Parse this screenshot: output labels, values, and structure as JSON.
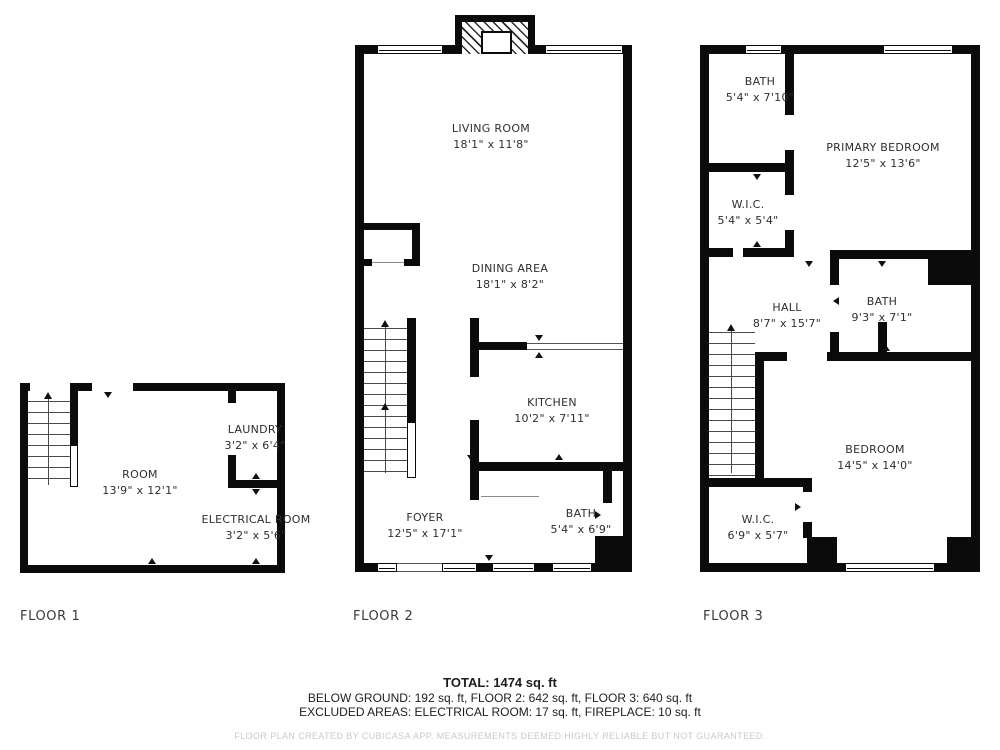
{
  "floors": [
    {
      "label": "FLOOR 1",
      "rooms": [
        {
          "name": "ROOM",
          "dims": "13'9\" x 12'1\""
        },
        {
          "name": "LAUNDRY",
          "dims": "3'2\" x 6'4\""
        },
        {
          "name": "ELECTRICAL ROOM",
          "dims": "3'2\" x 5'6\""
        }
      ]
    },
    {
      "label": "FLOOR 2",
      "rooms": [
        {
          "name": "LIVING ROOM",
          "dims": "18'1\" x 11'8\""
        },
        {
          "name": "DINING AREA",
          "dims": "18'1\" x 8'2\""
        },
        {
          "name": "KITCHEN",
          "dims": "10'2\" x 7'11\""
        },
        {
          "name": "FOYER",
          "dims": "12'5\" x 17'1\""
        },
        {
          "name": "BATH",
          "dims": "5'4\" x 6'9\""
        }
      ]
    },
    {
      "label": "FLOOR 3",
      "rooms": [
        {
          "name": "BATH",
          "dims": "5'4\" x 7'10\""
        },
        {
          "name": "PRIMARY BEDROOM",
          "dims": "12'5\" x 13'6\""
        },
        {
          "name": "W.I.C.",
          "dims": "5'4\" x 5'4\""
        },
        {
          "name": "HALL",
          "dims": "8'7\" x 15'7\""
        },
        {
          "name": "BATH",
          "dims": "9'3\" x 7'1\""
        },
        {
          "name": "BEDROOM",
          "dims": "14'5\" x 14'0\""
        },
        {
          "name": "W.I.C.",
          "dims": "6'9\" x 5'7\""
        }
      ]
    }
  ],
  "summary": {
    "total": "TOTAL: 1474 sq. ft",
    "floors_line": "BELOW GROUND: 192 sq. ft, FLOOR 2: 642 sq. ft, FLOOR 3: 640 sq. ft",
    "excluded_line": "EXCLUDED AREAS: ELECTRICAL ROOM: 17 sq. ft, FIREPLACE: 10 sq. ft",
    "disclaimer": "FLOOR PLAN CREATED BY CUBICASA APP. MEASUREMENTS DEEMED HIGHLY RELIABLE BUT NOT GUARANTEED."
  },
  "colors": {
    "wall": "#0b0b0b",
    "text": "#2e2e2e",
    "disclaimer": "#c9c9c9"
  }
}
